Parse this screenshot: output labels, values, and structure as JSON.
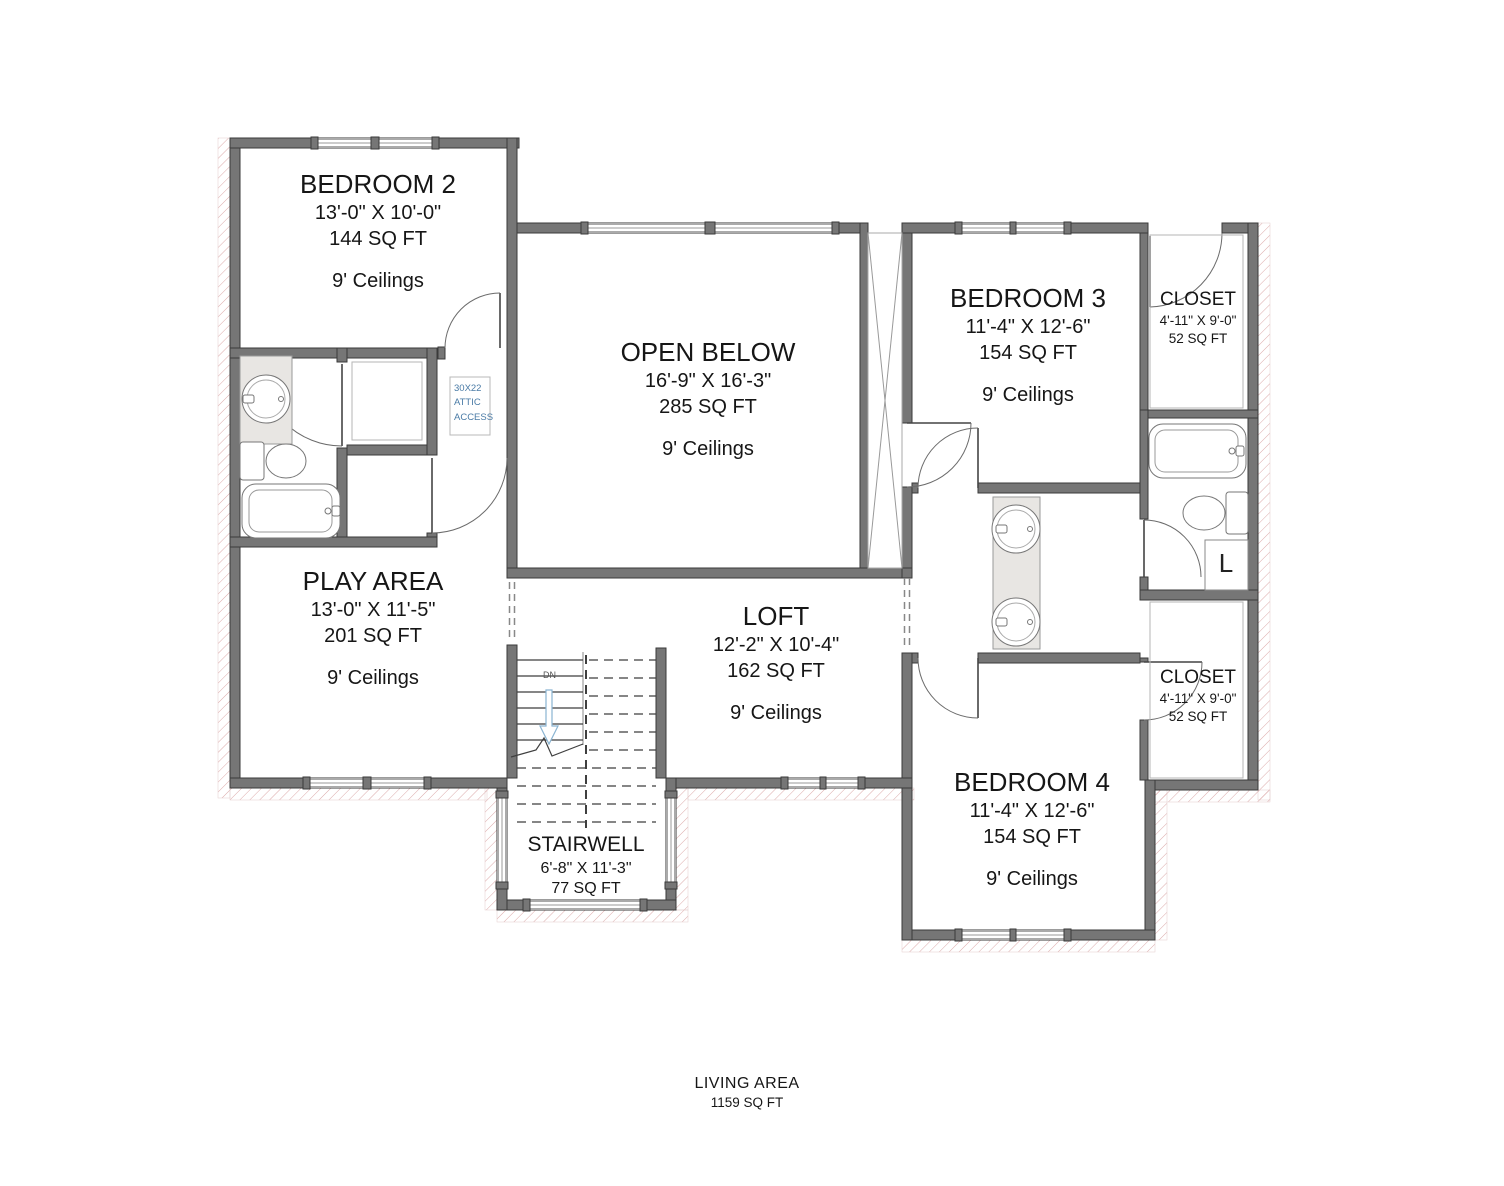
{
  "rooms": {
    "bedroom2": {
      "name": "BEDROOM 2",
      "dims": "13'-0\" X 10'-0\"",
      "area": "144 SQ FT",
      "ceiling": "9' Ceilings"
    },
    "open_below": {
      "name": "OPEN BELOW",
      "dims": "16'-9\" X 16'-3\"",
      "area": "285 SQ FT",
      "ceiling": "9' Ceilings"
    },
    "bedroom3": {
      "name": "BEDROOM 3",
      "dims": "11'-4\" X 12'-6\"",
      "area": "154 SQ FT",
      "ceiling": "9' Ceilings"
    },
    "closet_top": {
      "name": "CLOSET",
      "dims": "4'-11\" X 9'-0\"",
      "area": "52 SQ FT"
    },
    "play_area": {
      "name": "PLAY AREA",
      "dims": "13'-0\" X 11'-5\"",
      "area": "201 SQ FT",
      "ceiling": "9' Ceilings"
    },
    "loft": {
      "name": "LOFT",
      "dims": "12'-2\" X 10'-4\"",
      "area": "162 SQ FT",
      "ceiling": "9' Ceilings"
    },
    "bedroom4": {
      "name": "BEDROOM 4",
      "dims": "11'-4\" X 12'-6\"",
      "area": "154 SQ FT",
      "ceiling": "9' Ceilings"
    },
    "closet_bottom": {
      "name": "CLOSET",
      "dims": "4'-11\" X 9'-0\"",
      "area": "52 SQ FT"
    },
    "stairwell": {
      "name": "STAIRWELL",
      "dims": "6'-8\" X 11'-3\"",
      "area": "77 SQ FT"
    }
  },
  "annotations": {
    "attic_line1": "30X22",
    "attic_line2": "ATTIC",
    "attic_line3": "ACCESS",
    "stair_direction": "DN",
    "linen": "L"
  },
  "footer": {
    "label": "LIVING AREA",
    "area": "1159 SQ FT"
  },
  "colors": {
    "wall": "#767676",
    "wall_stroke": "#3a3a3a",
    "hatch": "#dcaaaa",
    "attic_text": "#4a7ba6",
    "arrow_blue": "#8ab4d2"
  }
}
